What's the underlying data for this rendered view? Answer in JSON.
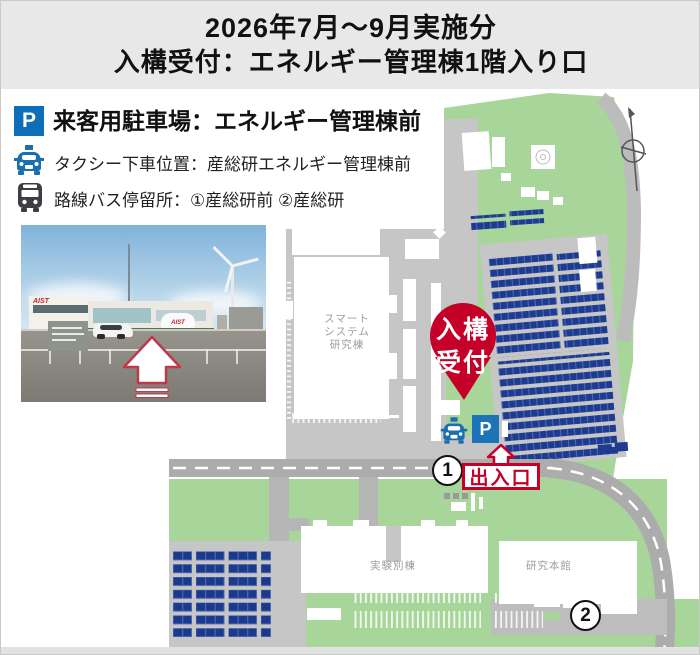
{
  "header": {
    "line1": "2026年7月〜9月実施分",
    "line2": "入構受付：エネルギー管理棟1階入り口"
  },
  "legend": {
    "parking_symbol": "P",
    "parking_label": "来客用駐車場：エネルギー管理棟前",
    "taxi_label": "タクシー下車位置：産総研エネルギー管理棟前",
    "bus_label": "路線バス停留所：①産総研前 ②産総研"
  },
  "photo": {
    "building_logo": "AIST",
    "tank_logo": "AIST"
  },
  "map": {
    "pin": {
      "line1": "入構",
      "line2": "受付"
    },
    "gate_label": "出入口",
    "parking_symbol": "P",
    "bus_stop_1": "1",
    "bus_stop_2": "2",
    "buildings": {
      "smart_system": [
        "スマート",
        "システム",
        "研究棟"
      ],
      "experiment_annex": "実験別棟",
      "research_main": "研究本館"
    }
  },
  "colors": {
    "header_bg": "#e8e8e8",
    "accent_red": "#c40028",
    "map_green": "#a8d59a",
    "road_gray": "#acacac",
    "plaza_gray": "#c6c6c6",
    "solar_blue": "#1e3c8f",
    "parking_blue": "#0e6eb8",
    "taxi_blue": "#1a6fb0",
    "bus_gray": "#3d3d42"
  }
}
